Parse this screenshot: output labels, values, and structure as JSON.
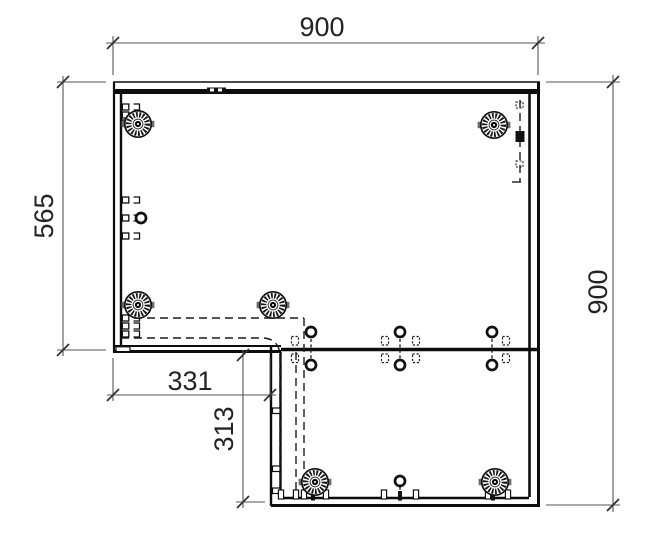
{
  "drawing": {
    "width": 657,
    "height": 545,
    "background": "#ffffff",
    "colors": {
      "part_line": "#0d0d0d",
      "dim_line": "#555555",
      "tick": "#333333",
      "text": "#242424",
      "hidden_line": "#1d1d1d",
      "fitting": "#111111",
      "tab_gray": "#6b6b6b"
    },
    "font_size": 27,
    "dimensions": [
      {
        "name": "width-top",
        "label": "900",
        "line": [
          106,
          43,
          545,
          43
        ],
        "ticks": [
          [
            113,
            43
          ],
          [
            538,
            43
          ]
        ],
        "ext": [
          [
            113,
            36,
            113,
            75
          ],
          [
            538,
            36,
            538,
            75
          ]
        ],
        "text": {
          "x": 322,
          "y": 36,
          "rotate": 0
        }
      },
      {
        "name": "height-left",
        "label": "565",
        "line": [
          63,
          76,
          63,
          356
        ],
        "ticks": [
          [
            63,
            82
          ],
          [
            63,
            350
          ]
        ],
        "ext": [
          [
            57,
            82,
            106,
            82
          ],
          [
            57,
            350,
            106,
            350
          ]
        ],
        "text": {
          "x": 53,
          "y": 216,
          "rotate": -90
        }
      },
      {
        "name": "notch-width",
        "label": "331",
        "line": [
          107,
          395,
          276,
          395
        ],
        "ticks": [
          [
            113,
            395
          ],
          [
            270,
            395
          ]
        ],
        "ext": [
          [
            113,
            358,
            113,
            401
          ],
          [
            270,
            358,
            270,
            401
          ]
        ],
        "text": {
          "x": 190,
          "y": 390,
          "rotate": 0
        }
      },
      {
        "name": "notch-height",
        "label": "313",
        "line": [
          243,
          350,
          243,
          508
        ],
        "ticks": [
          [
            243,
            355
          ],
          [
            243,
            502
          ]
        ],
        "ext": [
          [
            236,
            502,
            265,
            502
          ]
        ],
        "text": {
          "x": 233,
          "y": 429,
          "rotate": -90
        }
      },
      {
        "name": "height-right",
        "label": "900",
        "line": [
          613,
          75,
          613,
          512
        ],
        "ticks": [
          [
            613,
            82
          ],
          [
            613,
            505
          ]
        ],
        "ext": [
          [
            546,
            82,
            620,
            82
          ],
          [
            546,
            505,
            620,
            505
          ]
        ],
        "text": {
          "x": 607,
          "y": 292,
          "rotate": -90
        }
      }
    ],
    "outline": {
      "solid_lines": [
        {
          "x1": 113,
          "y1": 82,
          "x2": 540,
          "y2": 82,
          "w": 1.6
        },
        {
          "x1": 113,
          "y1": 91.5,
          "x2": 540,
          "y2": 91.5,
          "w": 5
        },
        {
          "x1": 114,
          "y1": 82,
          "x2": 114,
          "y2": 352,
          "w": 2.2
        },
        {
          "x1": 121,
          "y1": 94,
          "x2": 121,
          "y2": 346,
          "w": 2.4
        },
        {
          "x1": 538.5,
          "y1": 82,
          "x2": 538.5,
          "y2": 506,
          "w": 3
        },
        {
          "x1": 529.5,
          "y1": 94,
          "x2": 529.5,
          "y2": 497,
          "w": 2.6
        },
        {
          "x1": 113,
          "y1": 346,
          "x2": 281,
          "y2": 346,
          "w": 2
        },
        {
          "x1": 113,
          "y1": 351.5,
          "x2": 281,
          "y2": 351.5,
          "w": 3
        },
        {
          "x1": 271,
          "y1": 346,
          "x2": 271,
          "y2": 506,
          "w": 2.4
        },
        {
          "x1": 280.5,
          "y1": 352,
          "x2": 280.5,
          "y2": 497,
          "w": 2.4
        },
        {
          "x1": 271,
          "y1": 505.5,
          "x2": 540,
          "y2": 505.5,
          "w": 3
        },
        {
          "x1": 281,
          "y1": 498,
          "x2": 529,
          "y2": 498,
          "w": 2.4
        },
        {
          "x1": 281,
          "y1": 349.5,
          "x2": 540,
          "y2": 349.5,
          "w": 3.4
        }
      ],
      "connector_plate": {
        "x": 207,
        "y": 87.5,
        "w": 19,
        "h": 6.5,
        "notches": [
          [
            210,
            88.5,
            4,
            3
          ],
          [
            218,
            88.5,
            4,
            3
          ]
        ]
      },
      "corner_cap": {
        "x": 116,
        "y": 346.8,
        "w": 14,
        "h": 4.8
      }
    },
    "hidden_lines": {
      "dash_lines": [
        [
          121,
          318,
          304,
          318
        ],
        [
          304,
          318,
          304,
          494
        ],
        [
          121,
          338,
          264,
          338
        ],
        [
          296,
          352,
          296,
          494
        ],
        [
          280,
          355,
          280,
          494
        ],
        [
          520,
          100,
          520,
          182
        ]
      ],
      "dash_paths": [
        "M264,338 Q279,339.5 280,355"
      ],
      "foot_line": [
        512,
        182,
        521,
        182
      ],
      "black_square": {
        "x": 515.5,
        "y": 131,
        "w": 9,
        "h": 11
      },
      "top_right_brackets": [
        [
          516,
          102
        ],
        [
          516,
          161
        ]
      ]
    },
    "cams": [
      {
        "x": 138,
        "y": 124
      },
      {
        "x": 494,
        "y": 125
      },
      {
        "x": 138,
        "y": 305
      },
      {
        "x": 273,
        "y": 305
      },
      {
        "x": 315,
        "y": 482
      },
      {
        "x": 495,
        "y": 482
      }
    ],
    "dowels": [
      {
        "x": 141,
        "y": 218
      },
      {
        "x": 311,
        "y": 332
      },
      {
        "x": 311,
        "y": 365
      },
      {
        "x": 400,
        "y": 332
      },
      {
        "x": 400,
        "y": 365
      },
      {
        "x": 492,
        "y": 332
      },
      {
        "x": 492,
        "y": 365
      },
      {
        "x": 400,
        "y": 481
      }
    ],
    "dowel_links": [
      {
        "x": 311,
        "y1": 339,
        "y2": 359
      },
      {
        "x": 400,
        "y1": 339,
        "y2": 359
      },
      {
        "x": 492,
        "y1": 339,
        "y2": 359
      },
      {
        "x": 400,
        "y1": 487,
        "y2": 503
      }
    ],
    "edge_clip_rows": [
      107,
      115,
      123,
      200,
      218,
      236,
      318,
      326,
      334
    ],
    "mid_bracket_xs": [
      295,
      385,
      416,
      506
    ],
    "strip_clip_ys": [
      408,
      466,
      488
    ],
    "bottom_feet_xs": [
      281,
      296,
      304,
      326,
      384,
      416,
      488,
      508
    ],
    "bottom_dark_feet_xs": [
      313,
      400,
      493
    ]
  }
}
